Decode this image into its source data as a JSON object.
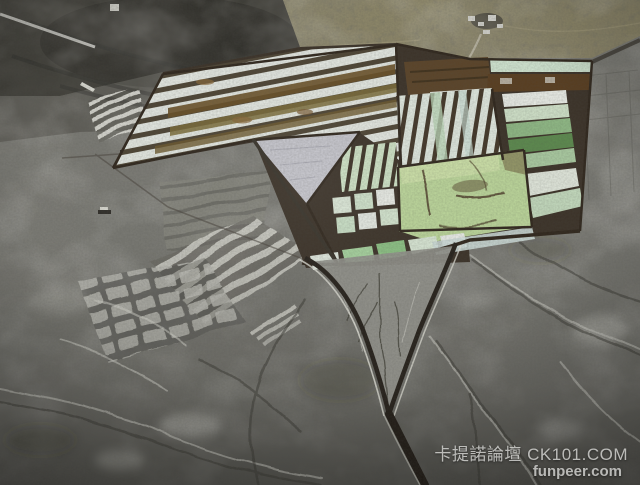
{
  "watermark": {
    "line1": "卡提諾論壇 CK101.COM",
    "line2": "funpeer.com"
  },
  "palette": {
    "terrain_gray": "#7a7a74",
    "terrain_dark": "#3a3933",
    "desert_olive": "#8d8769",
    "dike_brown": "#3d342a",
    "stripe_white": "#e4e8e2",
    "stripe_gap": "#4f4636",
    "stripe_brown": "#6a5128",
    "stripe_olive": "#7d6d3a",
    "pond_green": "#bcd69b",
    "pond_light": "#cfe2ab",
    "pale_green": "#cfe3c6",
    "dark_green": "#5d8a4f",
    "lavender": "#c6c6cd",
    "crust_white": "#e0e0d7",
    "wall_dark": "#28231d"
  }
}
